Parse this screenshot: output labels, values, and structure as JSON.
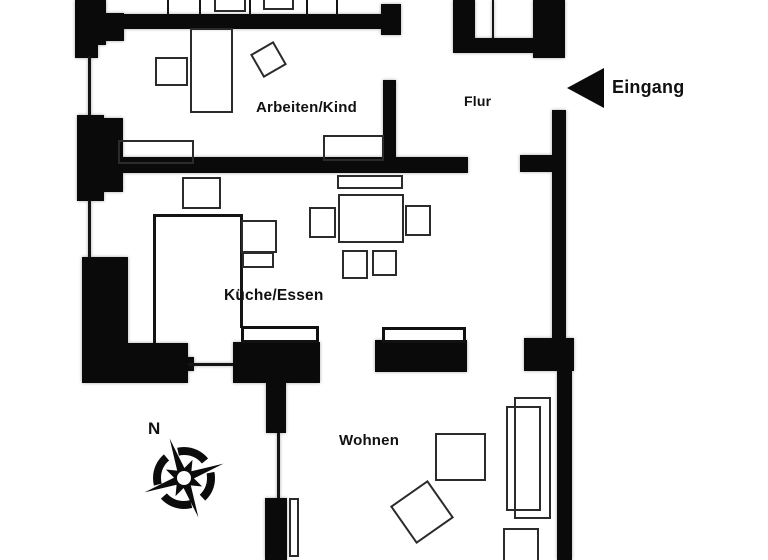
{
  "floorplan": {
    "rooms": [
      {
        "id": "arbeiten-kind",
        "label": "Arbeiten/Kind"
      },
      {
        "id": "flur",
        "label": "Flur"
      },
      {
        "id": "kueche-essen",
        "label": "Küche/Essen"
      },
      {
        "id": "wohnen",
        "label": "Wohnen"
      }
    ],
    "entrance_label": "Eingang",
    "compass_north_label": "N",
    "colors": {
      "wall": "#0a0a0a",
      "background": "#ffffff",
      "furniture_outline": "#2b2b2b",
      "text": "#111111"
    }
  }
}
